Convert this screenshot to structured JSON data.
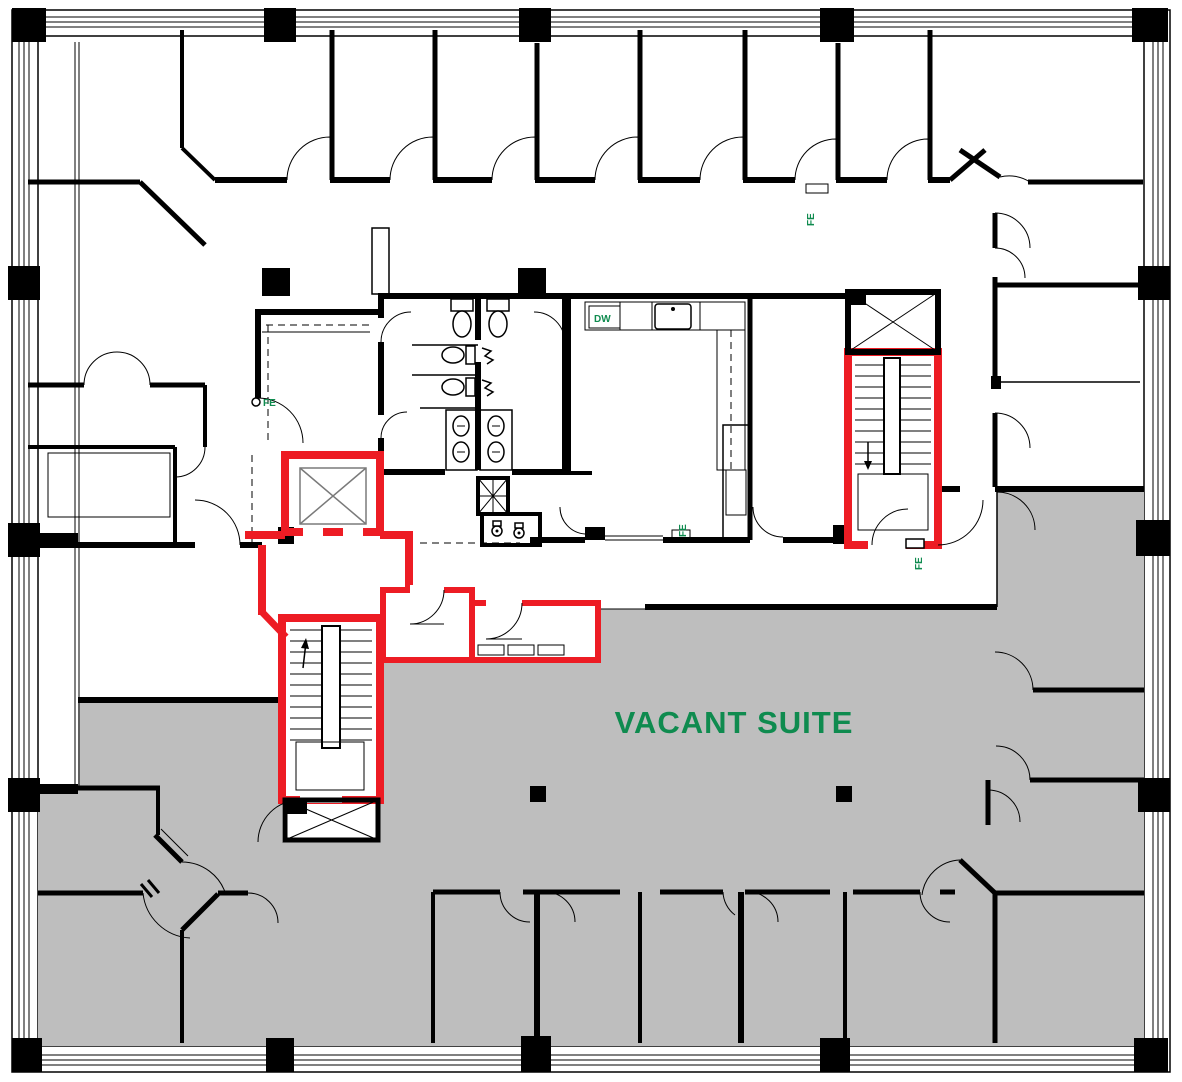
{
  "plan": {
    "labels": {
      "vacant_suite": "VACANT SUITE",
      "fire_extinguisher": "FE",
      "dishwasher": "DW"
    },
    "colors": {
      "wall": "#000000",
      "highlight_red": "#ed1c24",
      "vacant_gray": "#bebebe",
      "label_green": "#0f8b4f",
      "background": "#ffffff",
      "shaft_x_gray": "#7a7a7a"
    },
    "areas": {
      "vacant_suite_status": "VACANT SUITE",
      "fe_marker_count": "4"
    }
  }
}
